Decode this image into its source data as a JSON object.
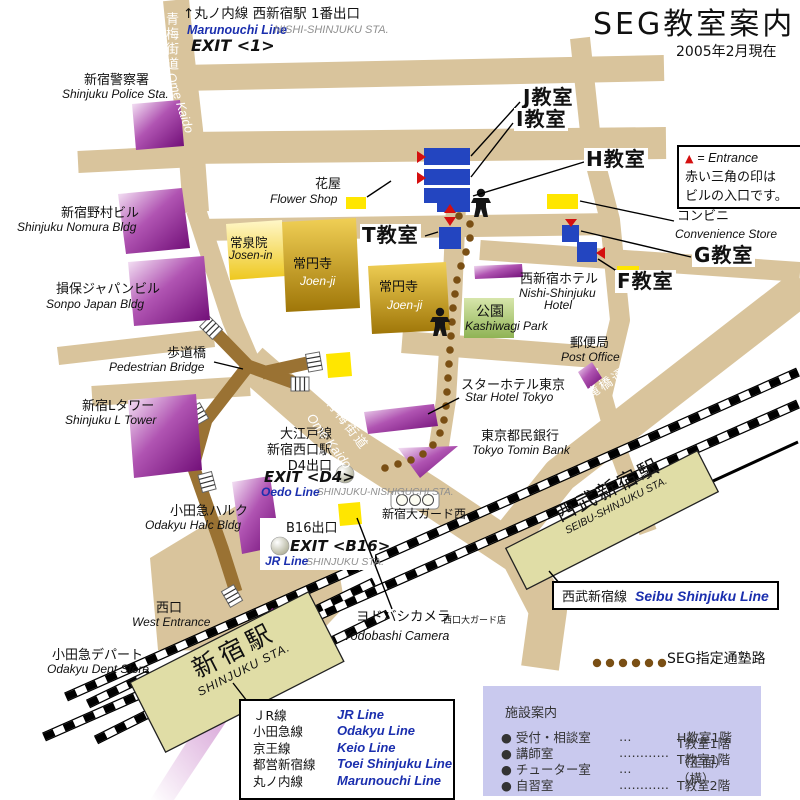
{
  "title": {
    "main": "SEG教室案内",
    "date": "2005年2月現在"
  },
  "entrance_legend": {
    "tri": "▲",
    "eq": "= Entrance",
    "l2": "赤い三角の印は",
    "l3": "ビルの入口です。"
  },
  "route_legend": "SEG指定通塾路",
  "rooms": {
    "j": "J教室",
    "i": "I教室",
    "h": "H教室",
    "t": "T教室",
    "g": "G教室",
    "f": "F教室"
  },
  "marunouchi": {
    "jp": "↑丸ノ内線 西新宿駅 1番出口",
    "line": "Marunouchi Line",
    "sta": "NISHI-SHINJUKU STA.",
    "exit": "EXIT <1>"
  },
  "ome_top": {
    "jp": "青梅街道",
    "en": "Ome Kaido"
  },
  "ome_mid": {
    "jp": "青梅街道",
    "en": "Ome Kaido"
  },
  "otakibashi": {
    "jp": "小滝橋通り",
    "en": "Otakibashi Dori"
  },
  "police": {
    "jp": "新宿警察署",
    "en": "Shinjuku Police Sta."
  },
  "nomura": {
    "jp": "新宿野村ビル",
    "en": "Shinjuku Nomura Bldg"
  },
  "sonpo": {
    "jp": "損保ジャパンビル",
    "en": "Sonpo Japan Bldg"
  },
  "bridge": {
    "jp": "歩道橋",
    "en": "Pedestrian Bridge"
  },
  "ltower": {
    "jp": "新宿Lタワー",
    "en": "Shinjuku L Tower"
  },
  "halc": {
    "jp": "小田急ハルク",
    "en": "Odakyu Halc Bldg"
  },
  "west": {
    "jp": "西口",
    "en": "West Entrance"
  },
  "odakyu_dept": {
    "jp": "小田急デパート",
    "en": "Odakyu Dept Store"
  },
  "shinjuku_sta": {
    "jp": "新宿駅",
    "en": "SHINJUKU STA."
  },
  "seibu_sta": {
    "jp": "西武新宿駅",
    "en": "SEIBU-SHINJUKU STA."
  },
  "seibu_line": {
    "jp": "西武新宿線",
    "en": "Seibu Shinjuku Line"
  },
  "yodobashi": {
    "jp": "ヨドバシカメラ",
    "branch": "西口大ガード店",
    "en": "Yodobashi Camera"
  },
  "oedo": {
    "l1": "大江戸線",
    "l2": "新宿西口駅",
    "l3": "D4出口",
    "exit": "EXIT <D4>",
    "line": "Oedo Line",
    "sta": "SHINJUKU-NISHIGUCHI STA."
  },
  "b16": {
    "jp": "B16出口",
    "exit": "EXIT <B16>",
    "line": "JR Line",
    "sta": "SHINJUKU STA."
  },
  "ogado": "新宿大ガード西",
  "flower": {
    "jp": "花屋",
    "en": "Flower Shop"
  },
  "josenin": {
    "jp": "常泉院",
    "en": "Josen-in"
  },
  "joenji": {
    "jp": "常円寺",
    "en": "Joen-ji"
  },
  "joenji2": {
    "jp": "常円寺",
    "en": "Joen-ji"
  },
  "park": {
    "jp": "公園",
    "en": "Kashiwagi Park"
  },
  "hotel_ns": {
    "jp": "西新宿ホテル",
    "en1": "Nishi-Shinjuku",
    "en2": "Hotel"
  },
  "post": {
    "jp": "郵便局",
    "en": "Post Office"
  },
  "star": {
    "jp": "スターホテル東京",
    "en": "Star Hotel Tokyo"
  },
  "bank": {
    "jp": "東京都民銀行",
    "en": "Tokyo Tomin Bank"
  },
  "conbini": {
    "jp": "コンビニ",
    "en": "Convenience Store"
  },
  "lines_box": {
    "rows": [
      {
        "jp": "ＪR線",
        "en": "JR Line"
      },
      {
        "jp": "小田急線",
        "en": "Odakyu Line"
      },
      {
        "jp": "京王線",
        "en": "Keio Line"
      },
      {
        "jp": "都営新宿線",
        "en": "Toei Shinjuku Line"
      },
      {
        "jp": "丸ノ内線",
        "en": "Marunouchi Line"
      }
    ]
  },
  "facility": {
    "title": "施設案内",
    "rows": [
      {
        "name": "● 受付・相談室",
        "dots": "…",
        "loc": "H教室1階"
      },
      {
        "name": "● 講師室",
        "dots": "…………",
        "loc": "T教室1階（正面）"
      },
      {
        "name": "● チューター室",
        "dots": "…",
        "loc": "T教室1階（横）"
      },
      {
        "name": "● 自習室",
        "dots": "…………",
        "loc": "T教室2階"
      }
    ]
  },
  "colors": {
    "road": "#d9c49c",
    "bridge": "#9a7233",
    "purple": "#6d0a74",
    "classroom_blue": "#2345c0",
    "gold": "#9f7608",
    "park_green": "#8fb355",
    "station_khaki": "#e0dda6",
    "marker_yellow": "#ffe600",
    "entrance_red": "#d40f0f",
    "route_brown": "#7a4f14",
    "line_blue": "#1b2fae",
    "facility_bg": "#c9c9ee"
  }
}
